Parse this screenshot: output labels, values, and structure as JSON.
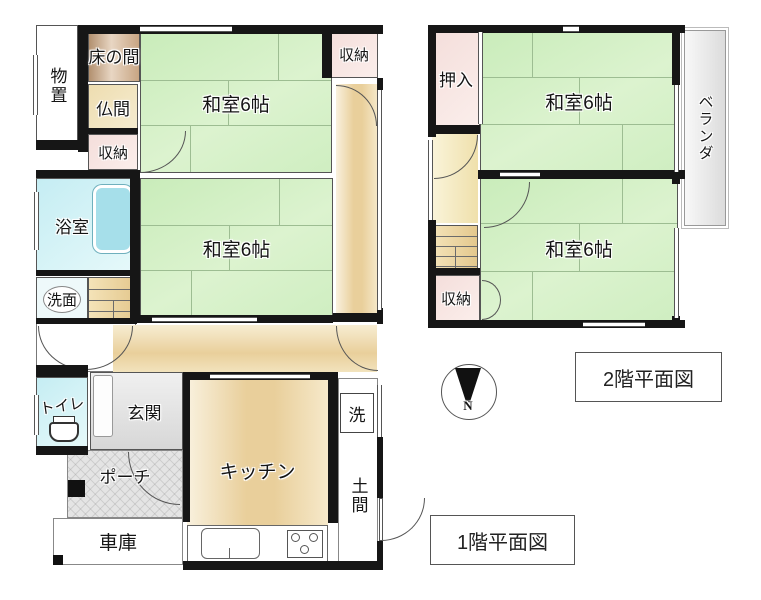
{
  "floor1": {
    "title": "1階平面図",
    "rooms": {
      "monooki": "物置",
      "tokonoma": "床の間",
      "butsuma": "仏間",
      "shuno_left": "収納",
      "shuno_right": "収納",
      "washitsu_top": "和室6帖",
      "washitsu_mid": "和室6帖",
      "yokushitsu": "浴室",
      "senmen": "洗面",
      "toilet": "トイレ",
      "genkan": "玄関",
      "porch": "ポーチ",
      "garage": "車庫",
      "kitchen": "キッチン",
      "laundry": "洗",
      "doma": "土間"
    }
  },
  "floor2": {
    "title": "2階平面図",
    "rooms": {
      "oshiire": "押入",
      "washitsu_north": "和室6帖",
      "washitsu_south": "和室6帖",
      "shuno": "収納",
      "veranda": "ベランダ"
    }
  },
  "compass": {
    "north": "N"
  },
  "colors": {
    "wall": "#161616",
    "tatami_green": "#dcf3cf",
    "storage_pink": "#f4dedb",
    "wood": "#e9cf9b",
    "bath_cyan": "#c5edf3"
  }
}
